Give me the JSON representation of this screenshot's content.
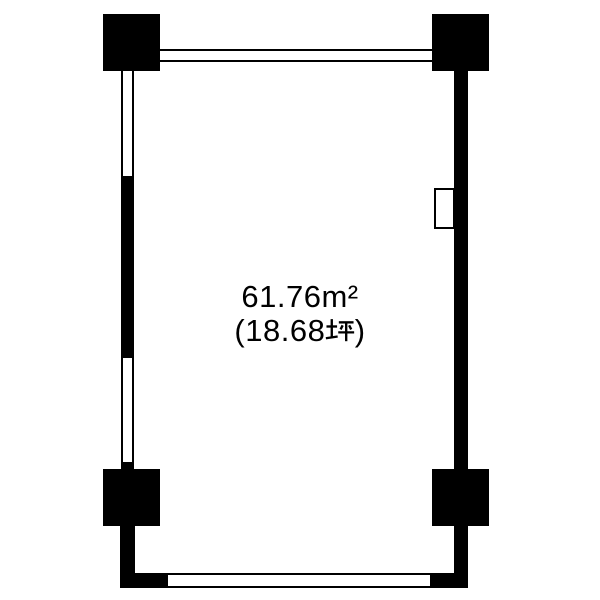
{
  "floor_plan": {
    "area_label": {
      "line1": "61.76m²",
      "line2_full": "(18.68坪)",
      "line2_open": "(18.68",
      "line2_unit": "坪",
      "line2_close": ")"
    },
    "colors": {
      "wall": "#000000",
      "floor": "#ffffff",
      "text": "#000000"
    }
  }
}
